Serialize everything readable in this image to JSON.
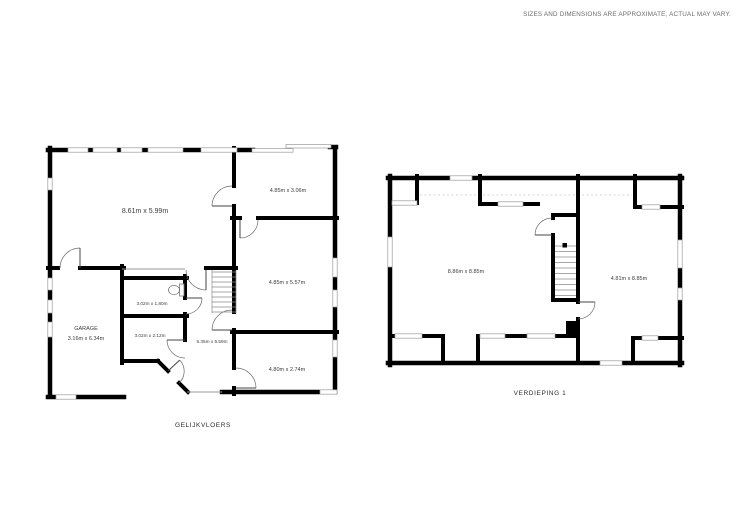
{
  "disclaimer": "SIZES AND DIMENSIONS ARE APPROXIMATE, ACTUAL MAY VARY.",
  "ground_floor": {
    "label": "GELIJKVLOERS",
    "rooms": {
      "living": "8.61m x 5.99m",
      "top_right": "4.85m x 3.06m",
      "mid_right": "4.85m x 5.57m",
      "wc": "3.02m x 1.80m",
      "storage": "3.02m x 2.12m",
      "hall": "5.35m x 5.59m",
      "bottom_right": "4.80m x 2.74m",
      "garage_name": "GARAGE",
      "garage_dims": "3.16m x 6.34m"
    }
  },
  "first_floor": {
    "label": "VERDIEPING 1",
    "rooms": {
      "left": "8.86m x 8.85m",
      "right": "4.81m x 8.85m"
    }
  },
  "colors": {
    "wall": "#000000",
    "window_stroke": "#9a9a9a",
    "dimension_text": "#3c3c3c",
    "disclaimer_text": "#6b6b6b",
    "background": "#ffffff"
  }
}
